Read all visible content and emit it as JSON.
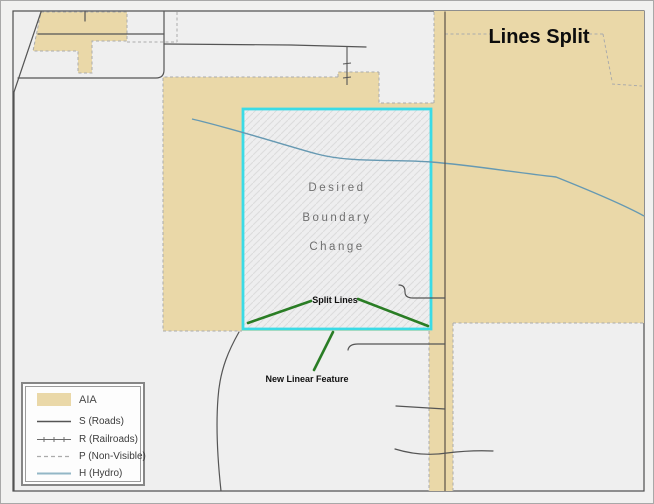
{
  "page": {
    "title": "Lines Split"
  },
  "map": {
    "boundary_label": {
      "line1": "Desired",
      "line2": "Boundary",
      "line3": "Change"
    },
    "split_lines_label": "Split Lines",
    "new_linear_feature_label": "New Linear Feature"
  },
  "legend": {
    "items": [
      {
        "label": "AIA",
        "symbol": "aia-fill-swatch"
      },
      {
        "label": "S (Roads)",
        "symbol": "road-line-swatch"
      },
      {
        "label": "R (Railroads)",
        "symbol": "railroad-line-swatch"
      },
      {
        "label": "P (Non-Visible)",
        "symbol": "dashed-line-swatch"
      },
      {
        "label": "H (Hydro)",
        "symbol": "hydro-line-swatch"
      }
    ]
  },
  "colors": {
    "aia_fill": "#ead8a8",
    "boundary_cyan": "#3bdbe6",
    "annotation_green": "#2a7d25",
    "hydro_blue": "#6699b2",
    "road_gray": "#555555",
    "dashed_gray": "#ababab",
    "map_background": "#efefef"
  }
}
